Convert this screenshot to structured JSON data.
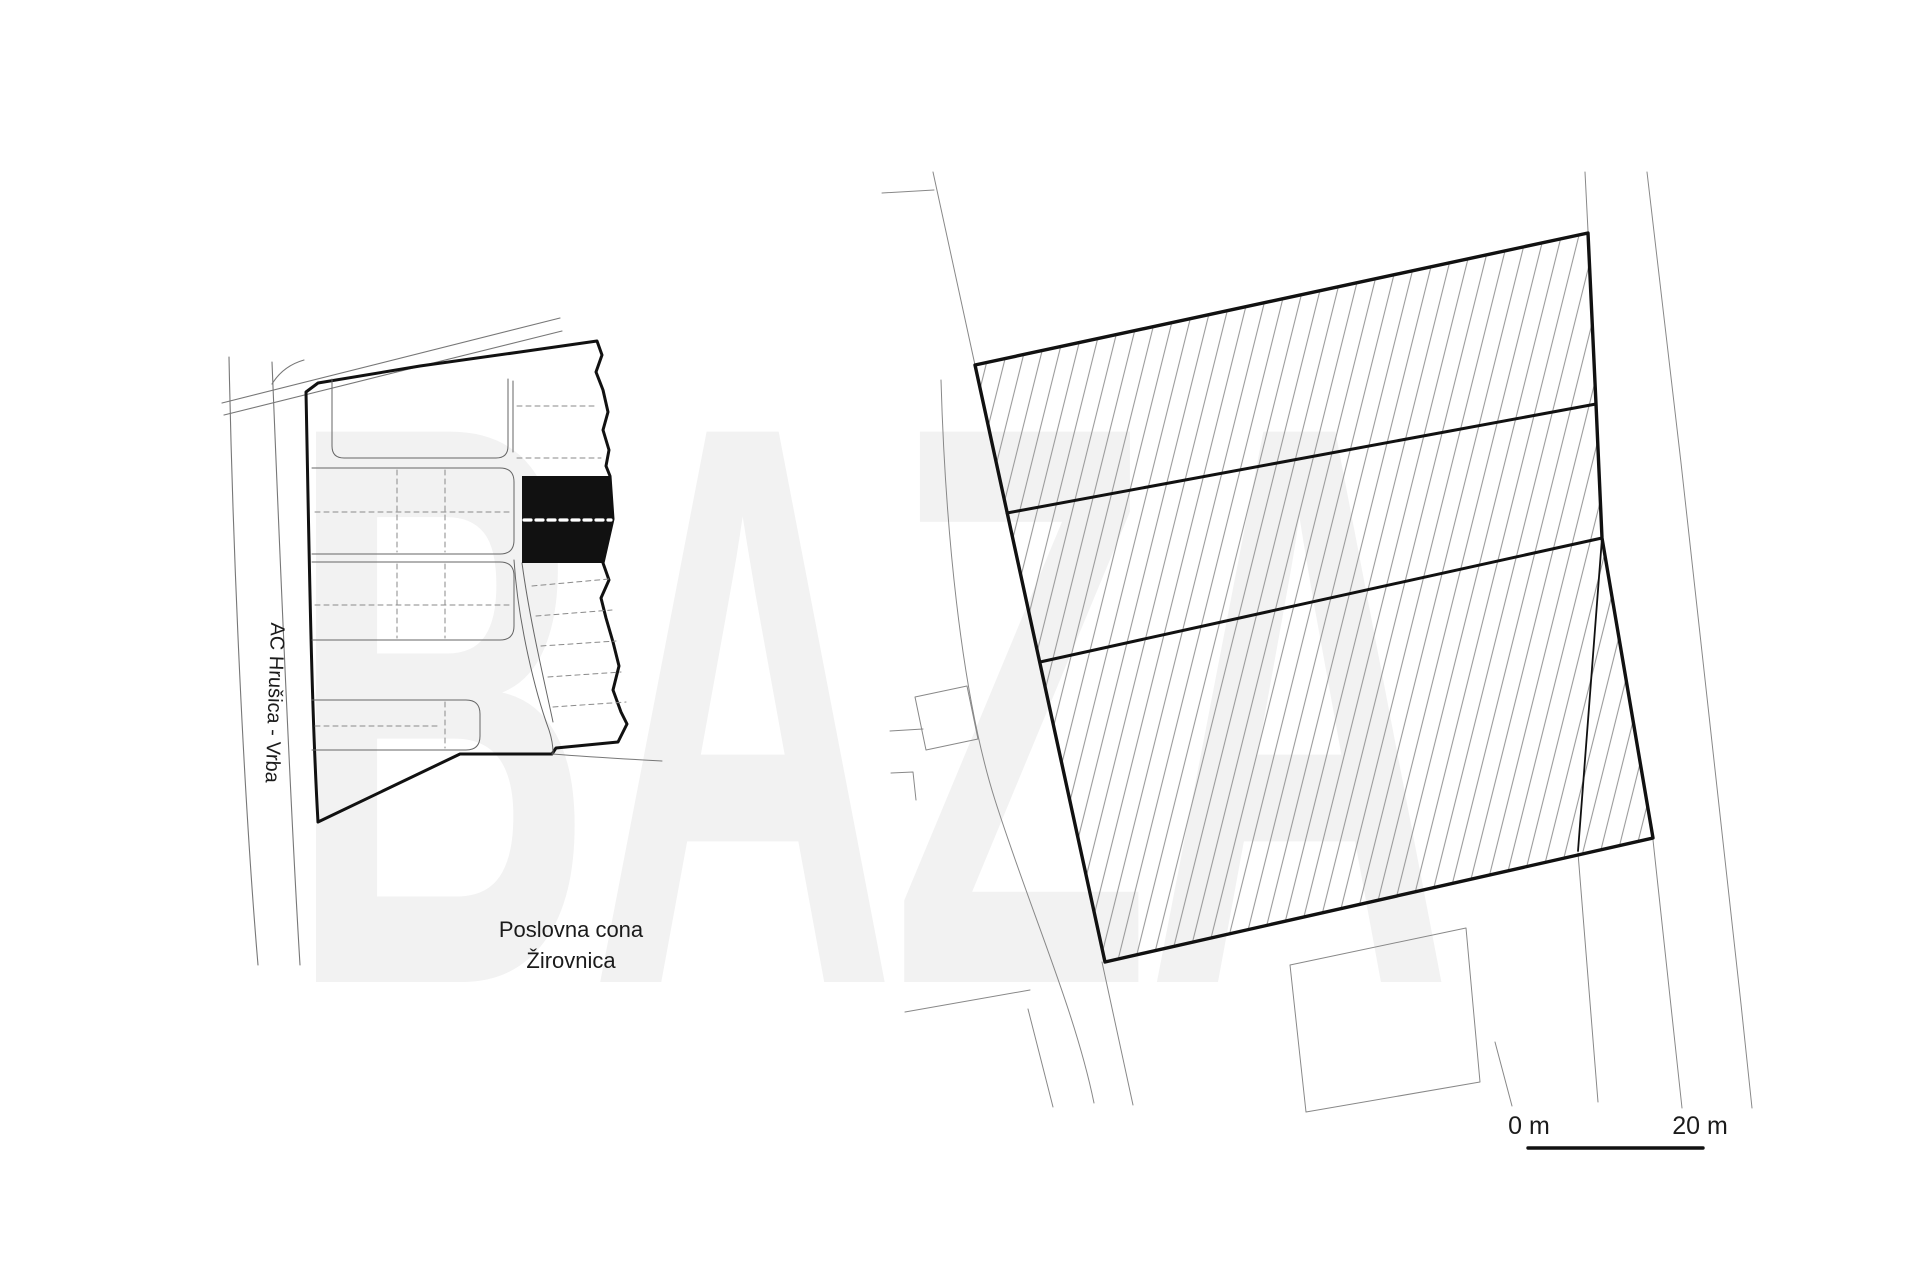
{
  "page": {
    "background_color": "#ffffff",
    "watermark": {
      "text": "BAZA",
      "color": "#f2f2f2"
    }
  },
  "location_map": {
    "highway_label": "AC Hrušica - Vrba",
    "zone_label_line1": "Poslovna cona",
    "zone_label_line2": "Žirovnica",
    "boundary_color": "#111111",
    "highlighted_parcel_color": "#111111",
    "highlight_divider_color": "#ffffff",
    "thin_line_color": "#777777"
  },
  "site_plan": {
    "parcel_strip_count": 3,
    "outline_color": "#111111",
    "hatch_line_color": "#9a9a9a",
    "context_line_color": "#888888"
  },
  "scale_bar": {
    "start_label": "0 m",
    "end_label": "20 m",
    "bar_color": "#111111"
  }
}
